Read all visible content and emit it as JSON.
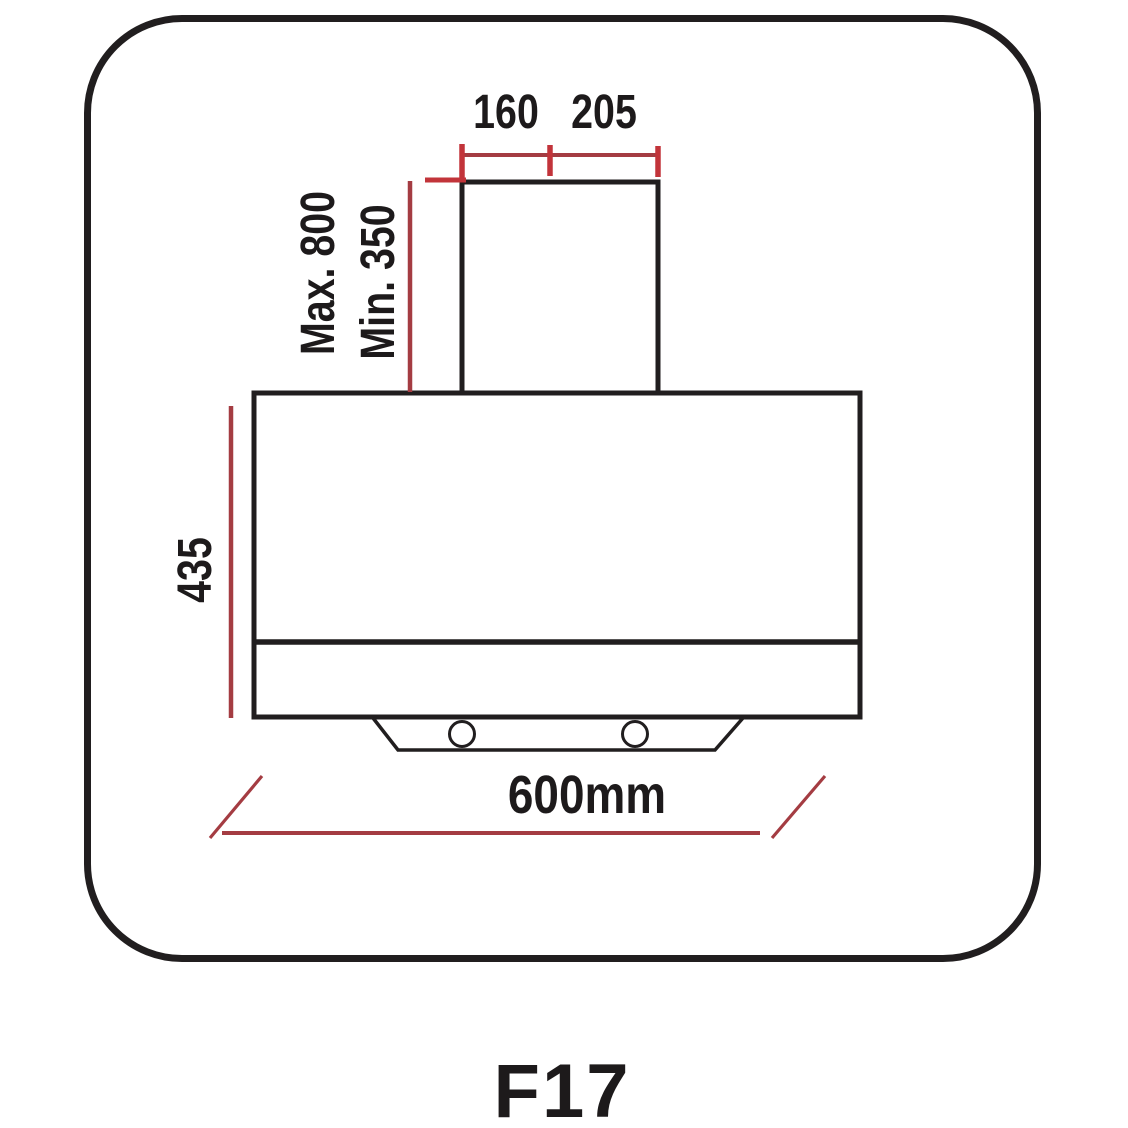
{
  "colors": {
    "line_black": "#211e1f",
    "dim_red": "#a43c42",
    "tick_red": "#c2343a",
    "text_black": "#1d1a1b",
    "bg": "#ffffff"
  },
  "diagram": {
    "type": "cooker-hood-dimension-drawing",
    "labels": {
      "duct_width_left": "160",
      "duct_width_right": "205",
      "chimney_height_max": "Max. 800",
      "chimney_height_min": "Min. 350",
      "body_height": "435",
      "hood_width": "600mm"
    },
    "model": "F17"
  }
}
